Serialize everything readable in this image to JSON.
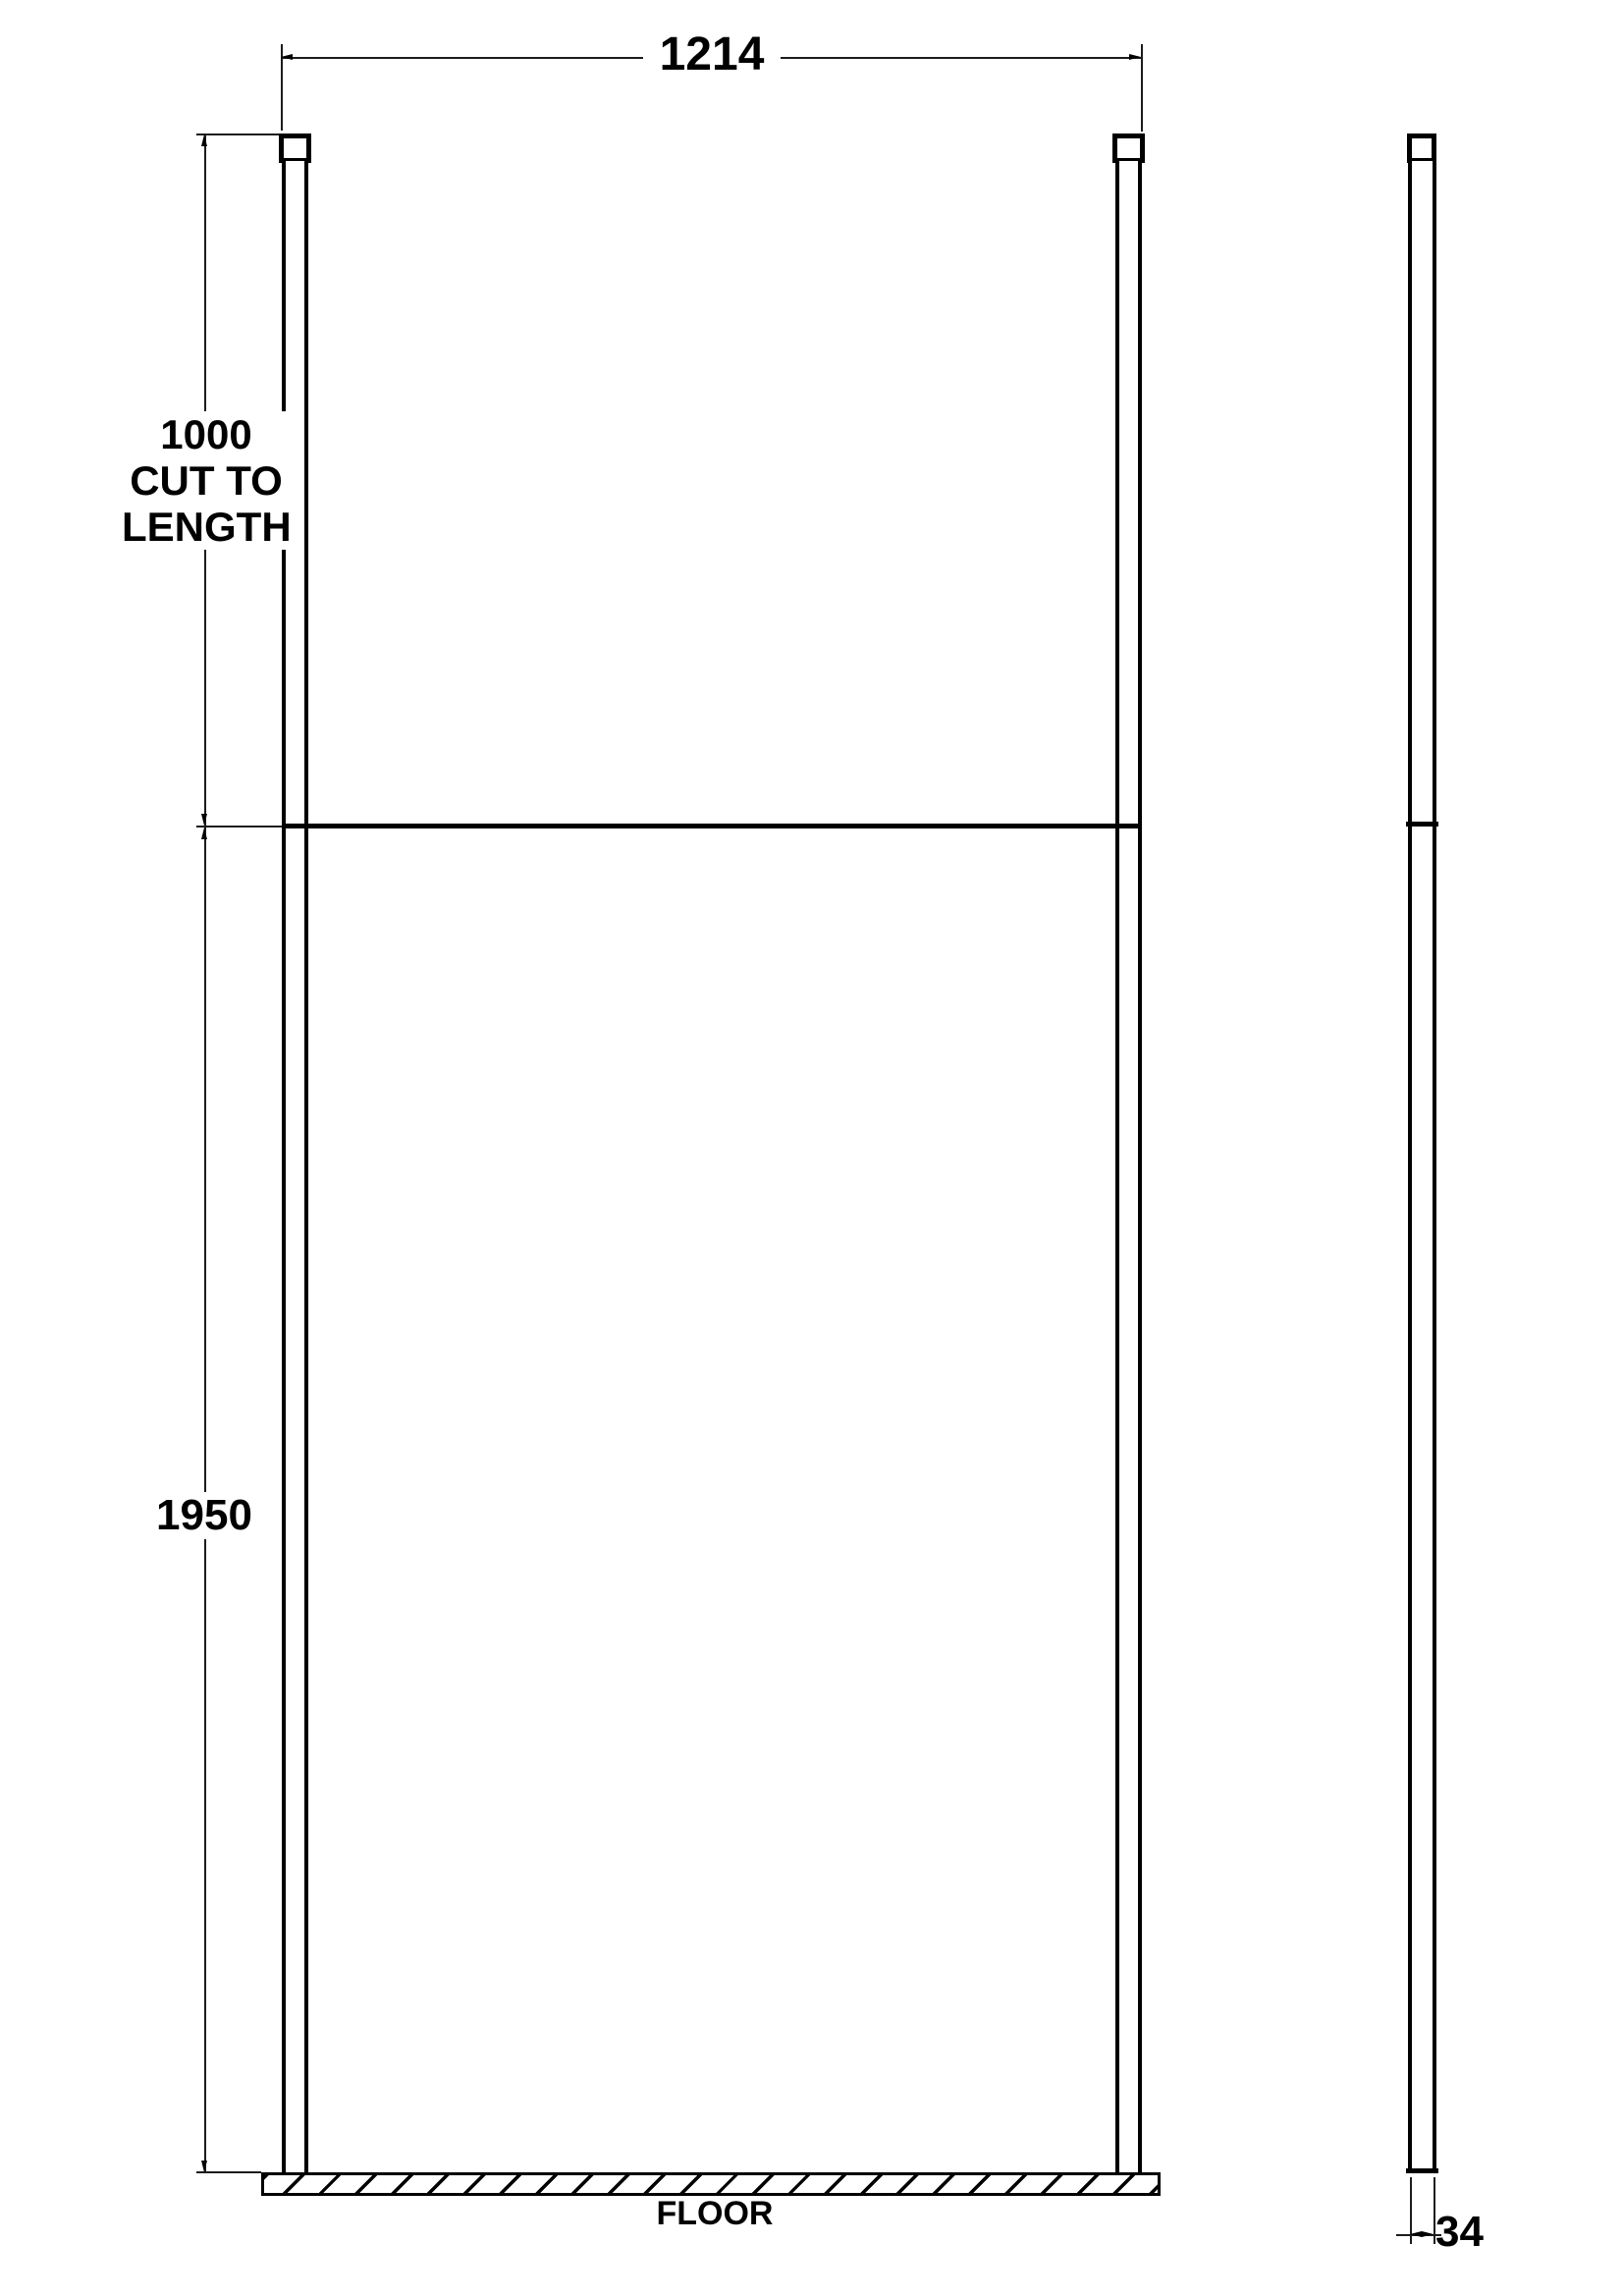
{
  "front_view": {
    "width_dimension": "1214",
    "post_dimension_lines": [
      "1000",
      "CUT TO",
      "LENGTH"
    ],
    "panel_height_dimension": "1950",
    "floor_label": "FLOOR"
  },
  "side_view": {
    "depth_dimension": "34"
  },
  "colors": {
    "line": "#000000",
    "background": "#ffffff"
  }
}
